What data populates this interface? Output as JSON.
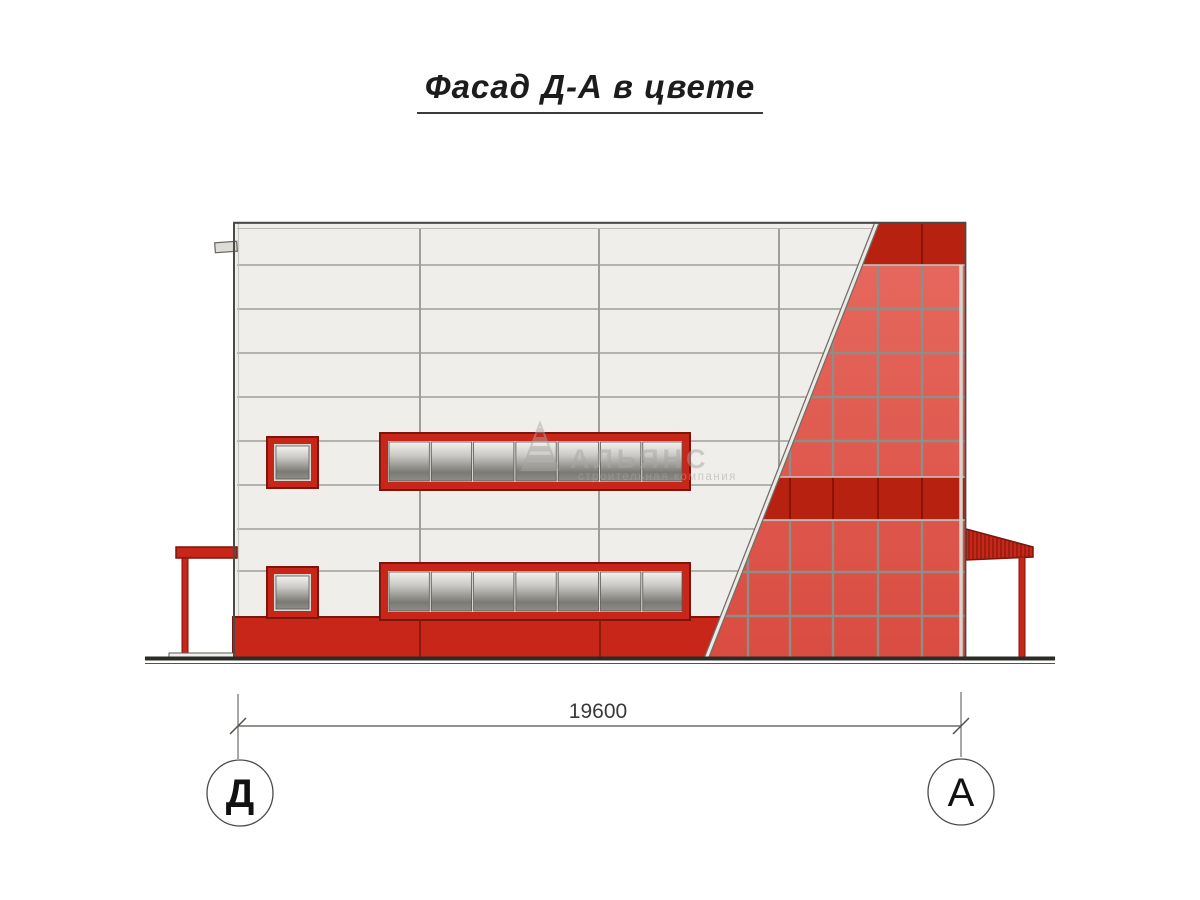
{
  "title": {
    "text": "Фасад Д-А в цвете"
  },
  "dimension": {
    "value": "19600"
  },
  "axes": {
    "left": "Д",
    "right": "А"
  },
  "watermark": {
    "name": "АЛЬЯНС",
    "tagline": "строительная компания"
  },
  "colors": {
    "red": "#c9261a",
    "red_dark_band": "#b7210f",
    "red_outline": "#7c150c",
    "red_divider": "#8c1206",
    "glaze_light": "#e76a60",
    "glaze_dark": "#d94c41",
    "panel_white": "#efeeea",
    "panel_line": "#a09e98",
    "mullion_gray": "#8f8d88",
    "glass_light": "#f2f2ef",
    "glass_dark": "#7b7a75",
    "ink": "#3a3a3a"
  }
}
